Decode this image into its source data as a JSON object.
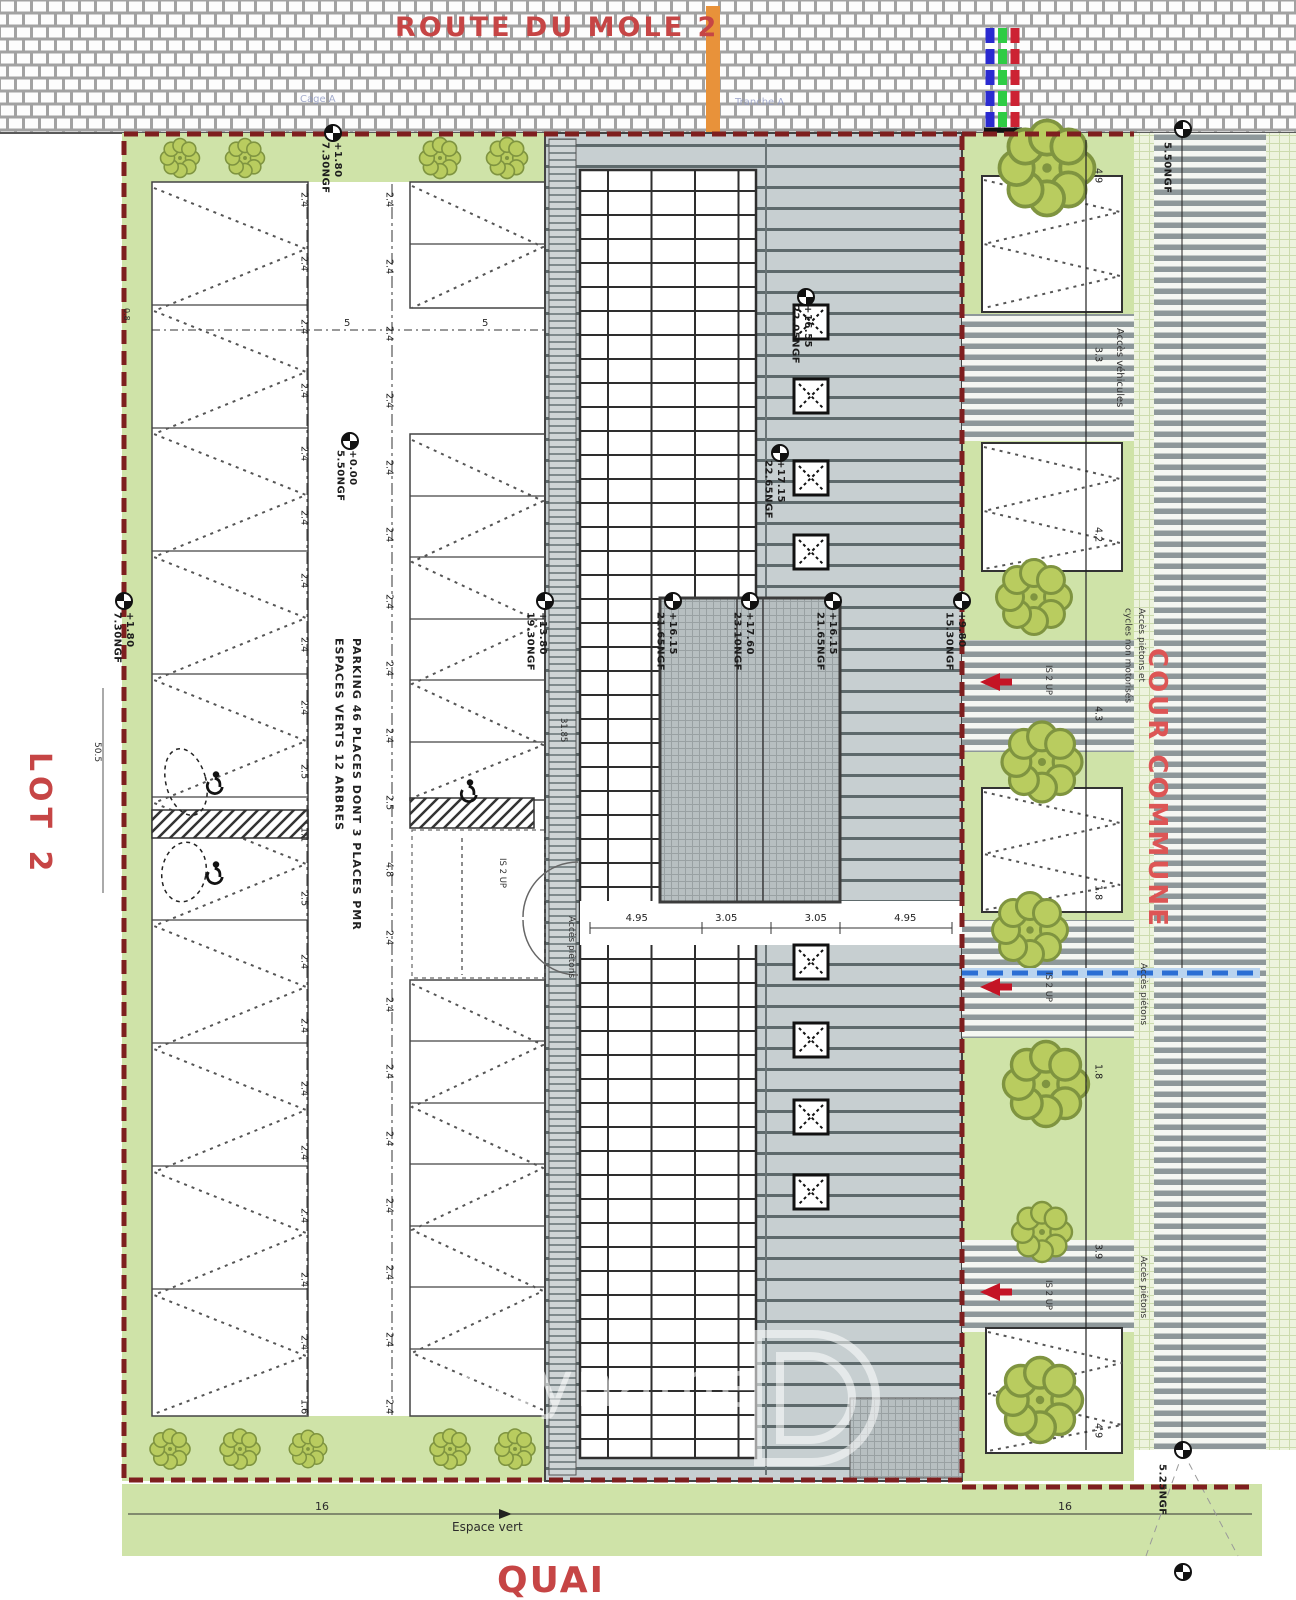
{
  "plan": {
    "streets": {
      "top": "ROUTE DU MOLE 2",
      "bottom": "QUAI"
    },
    "zones": {
      "lot": "LOT 2",
      "cour": "COUR COMMUNE",
      "espace_vert": "Espace vert"
    },
    "faint": {
      "left": "Cage A",
      "right": "Tranche A"
    },
    "parking_note": {
      "line1": "PARKING 46 PLACES DONT 3 PLACES PMR",
      "line2": "ESPACES VERTS 12 ARBRES"
    },
    "markers": {
      "m1": {
        "value": "+1.80",
        "ngf": "7.30NGF"
      },
      "m2": {
        "value": "+0.00",
        "ngf": "5.50NGF"
      },
      "m3": {
        "value": "+1.80",
        "ngf": "7.30NGF"
      },
      "m4": {
        "value": "+13.80",
        "ngf": "19.30NGF"
      },
      "m5": {
        "value": "+16.15",
        "ngf": "21.65NGF"
      },
      "m6": {
        "value": "+17.60",
        "ngf": "23.10NGF"
      },
      "m7": {
        "value": "+16.15",
        "ngf": "21.65NGF"
      },
      "m8": {
        "value": "+16.55",
        "ngf": "22.05NGF"
      },
      "m9": {
        "value": "+17.15",
        "ngf": "22.65NGF"
      },
      "m10": {
        "value": "+9.80",
        "ngf": "15.30NGF"
      },
      "m11": {
        "ngf": "5.50NGF"
      },
      "m12": {
        "ngf": "5.25NGF"
      }
    },
    "access": {
      "vehicles": "Accès véhicules",
      "ped_cycles_1": "Accès piétons et",
      "ped_cycles_2": "cycles non motorisés",
      "pedestrians": "Accès piétons",
      "stair": "IS 2 UP"
    },
    "dims": {
      "chainA": [
        "2.4",
        "2.4",
        "2.4",
        "2.4",
        "2.4",
        "2.4",
        "2.4",
        "2.4",
        "2.4",
        "2.5",
        "1.1",
        "2.5",
        "2.4",
        "2.4",
        "2.4",
        "2.4",
        "2.4",
        "2.4",
        "2.4",
        "1.6"
      ],
      "chainB": [
        "2.4",
        "2.4",
        "2.4",
        "2.4",
        "2.4",
        "2.4",
        "2.4",
        "2.4",
        "2.4",
        "2.5",
        "4.8",
        "2.4",
        "2.4",
        "2.4",
        "2.4",
        "2.4",
        "2.4",
        "2.4",
        "2.4"
      ],
      "rightChain": [
        "4.9",
        "3.3",
        "4.2",
        "4.3",
        "1.8",
        "1.8",
        "3.9",
        "4.9"
      ],
      "buildingLine": [
        "4.95",
        "3.05",
        "3.05",
        "4.95"
      ],
      "aisle": "5",
      "total_left": "50.5",
      "left_small": "0.8",
      "mid_small": "31.85",
      "bottom_left": "16",
      "bottom_right": "16"
    },
    "watermark": {
      "text": "cityname",
      "logo": "D"
    },
    "colors": {
      "boundary": "#7e1f1f",
      "red_text": "#c64545",
      "orange": "#e8923a",
      "green": "#cfe3a8",
      "tree": "#b9cc5f",
      "roof": "#c7cfd1",
      "blue_line": "#2b6fd4",
      "arrow_red": "#c41425",
      "strip_blue": "#2a2ad0",
      "strip_green": "#2ecc44",
      "strip_red": "#cc2233"
    }
  }
}
